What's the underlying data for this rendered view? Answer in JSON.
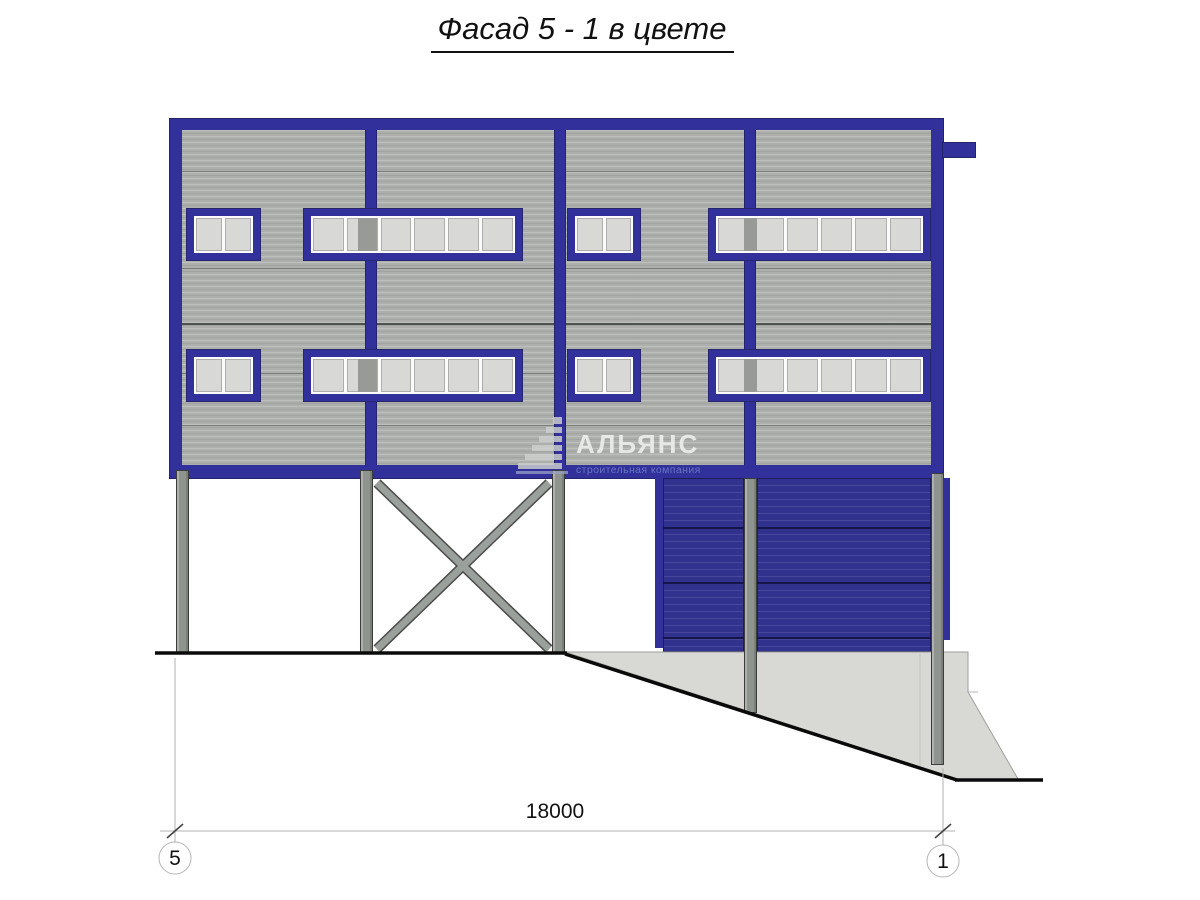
{
  "title": "Фасад 5 - 1 в цвете",
  "watermark": {
    "name": "АЛЬЯНС",
    "subtitle": "строительная компания"
  },
  "dimension": {
    "value": "18000"
  },
  "axis_markers": {
    "left": "5",
    "right": "1"
  },
  "colors": {
    "frame_blue": "#32319c",
    "door_blue": "#31318e",
    "siding_gray": "#adafac",
    "column_gray": "#8f948f",
    "concrete_gray": "#d8d8d5",
    "ground_black": "#0a0a0a",
    "watermark_subtitle_blue": "#6879c3"
  }
}
